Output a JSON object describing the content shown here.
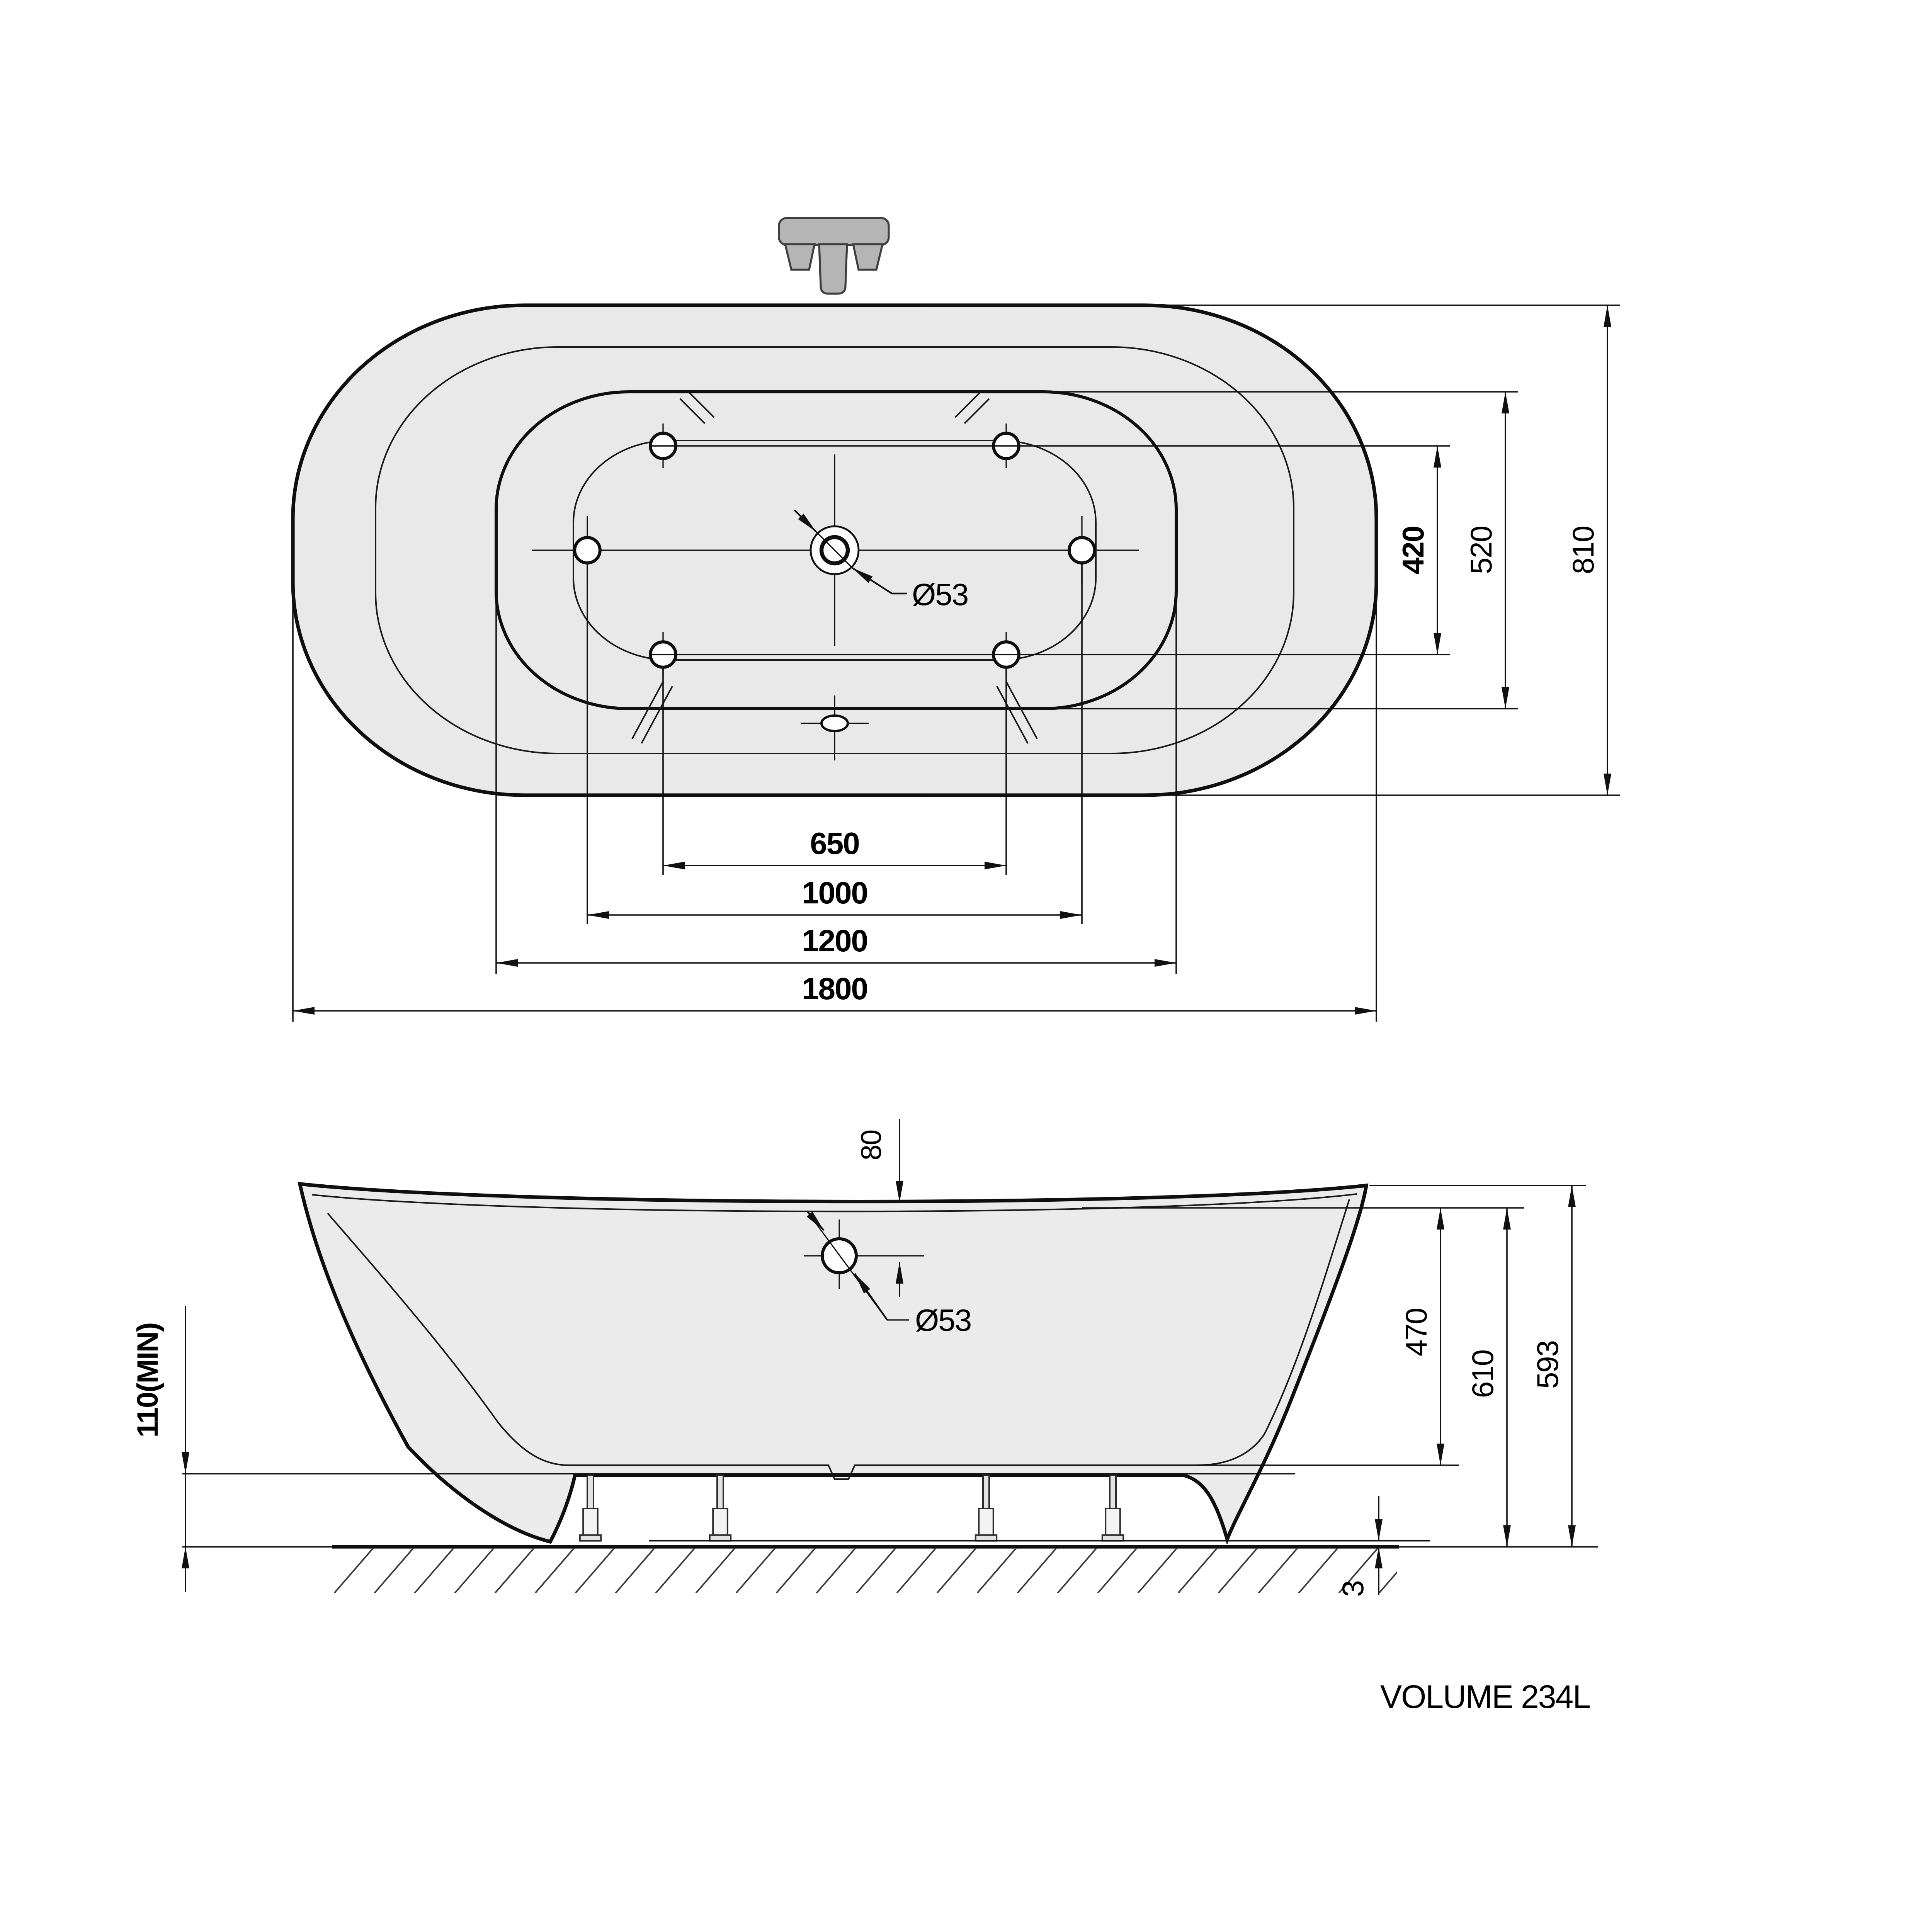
{
  "drawing": {
    "volume_label": "VOLUME 234L",
    "colors": {
      "line": "#111111",
      "body_fill": "#e9e9e9",
      "faucet_fill": "#b5b5b5",
      "background": "#ffffff"
    },
    "top_view": {
      "dim_650": "650",
      "dim_1000": "1000",
      "dim_1200": "1200",
      "dim_1800": "1800",
      "dim_420": "420",
      "dim_520": "520",
      "dim_810": "810",
      "drain_label": "Ø53"
    },
    "side_view": {
      "dim_80": "80",
      "drain_label": "Ø53",
      "dim_470": "470",
      "dim_610": "610",
      "dim_593": "593",
      "dim_3": "3",
      "dim_110": "110(MIN)"
    }
  }
}
